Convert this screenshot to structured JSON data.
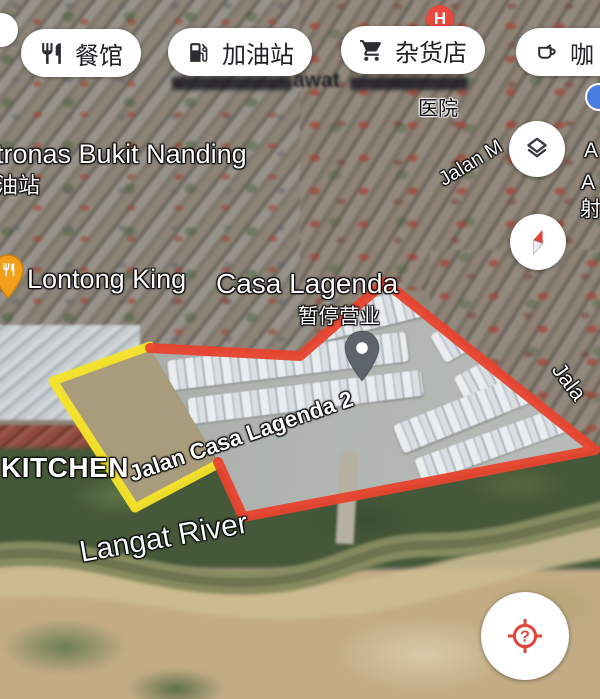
{
  "app": "google-maps-satellite-view",
  "chips": [
    {
      "label": "餐馆",
      "icon": "restaurant-icon"
    },
    {
      "label": "加油站",
      "icon": "gas-station-icon"
    },
    {
      "label": "杂货店",
      "icon": "grocery-cart-icon"
    },
    {
      "label": "咖",
      "icon": "coffee-cup-icon"
    }
  ],
  "labels": {
    "place_top": "tronas Bukit Nanding",
    "place_top_sub": "油站",
    "hospital": "医院",
    "obscured_fragment": "awat",
    "street_jalan_m": "Jalan M",
    "edge_label_1": "A",
    "edge_label_2": "A",
    "edge_label_3": "射",
    "restaurant_poi": "Lontong King",
    "estate_name": "Casa Lagenda",
    "estate_status": "暂停营业",
    "kitchen_poi": "KITCHEN",
    "street_main": "Jalan Casa Lagenda 2",
    "street_edge": "Jala",
    "river": "Langat River"
  },
  "markers": {
    "hospital_badge": "H",
    "locate_glyph": "?"
  },
  "overlays": {
    "red_route_points": "150,348 300,356 385,282 595,450 243,517 218,462",
    "yellow_route_points": "150,346 53,381 135,508 218,464"
  },
  "colors": {
    "route_red": "#e8432e",
    "route_yellow": "#f4e428",
    "hospital_red": "#e9483f",
    "poi_blue": "#4a7de0",
    "pin_orange": "#f2a01c",
    "pin_gray": "#5d646b",
    "chip_text": "#202124"
  }
}
